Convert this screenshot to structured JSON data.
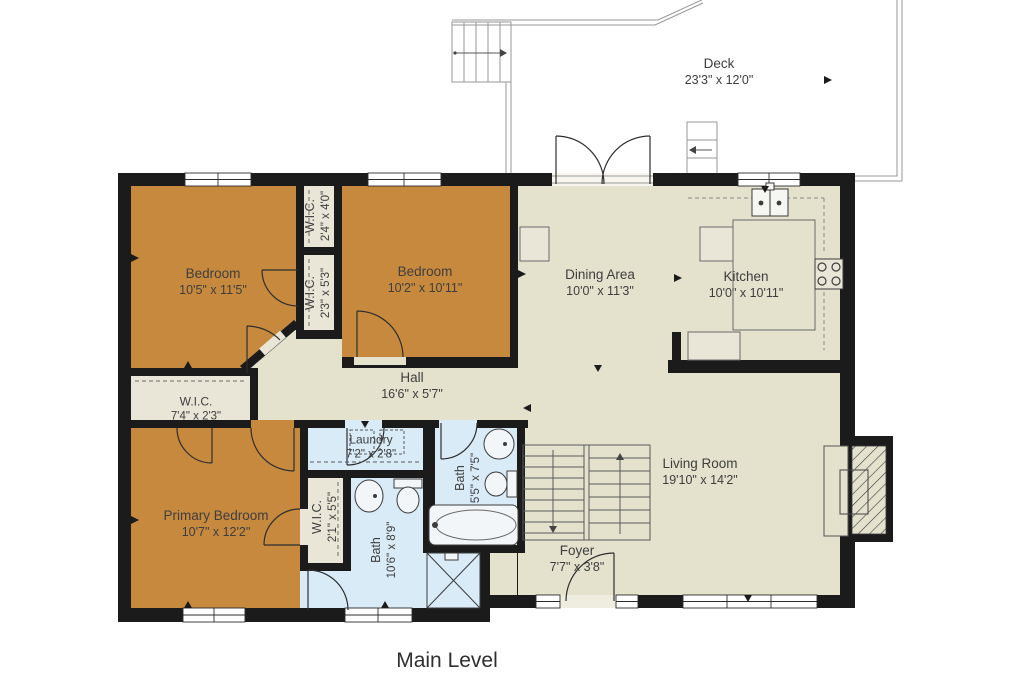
{
  "floor_label": "Main Level",
  "rooms": {
    "deck": {
      "name": "Deck",
      "dims": "23'3\" x 12'0\""
    },
    "bedroom1": {
      "name": "Bedroom",
      "dims": "10'5\" x 11'5\""
    },
    "wic1": {
      "name": "W.I.C.",
      "dims": "2'4\" x 4'0\""
    },
    "wic2": {
      "name": "W.I.C.",
      "dims": "2'3\" x 5'3\""
    },
    "bedroom2": {
      "name": "Bedroom",
      "dims": "10'2\" x 10'11\""
    },
    "dining": {
      "name": "Dining Area",
      "dims": "10'0\" x 11'3\""
    },
    "kitchen": {
      "name": "Kitchen",
      "dims": "10'0\" x 10'11\""
    },
    "hall": {
      "name": "Hall",
      "dims": "16'6\" x 5'7\""
    },
    "wic3": {
      "name": "W.I.C.",
      "dims": "7'4\" x 2'3\""
    },
    "laundry": {
      "name": "Laundry",
      "dims": "7'2\" x 2'8\""
    },
    "bath1": {
      "name": "Bath",
      "dims": "5'5\" x 7'5\""
    },
    "primary": {
      "name": "Primary Bedroom",
      "dims": "10'7\" x 12'2\""
    },
    "wic4": {
      "name": "W.I.C.",
      "dims": "2'1\" x 5'5\""
    },
    "bath2": {
      "name": "Bath",
      "dims": "10'6\" x 8'9\""
    },
    "living": {
      "name": "Living Room",
      "dims": "19'10\" x 14'2\""
    },
    "foyer": {
      "name": "Foyer",
      "dims": "7'7\" x 3'8\""
    }
  },
  "colors": {
    "wall": "#1b1b1b",
    "bedroom": "#c6893e",
    "living": "#e4e1cd",
    "bath": "#d8ebf7",
    "closet": "#e9e6d8",
    "deckline": "#979797",
    "text": "#3e3e3e",
    "fixture": "#4a4a4a"
  }
}
